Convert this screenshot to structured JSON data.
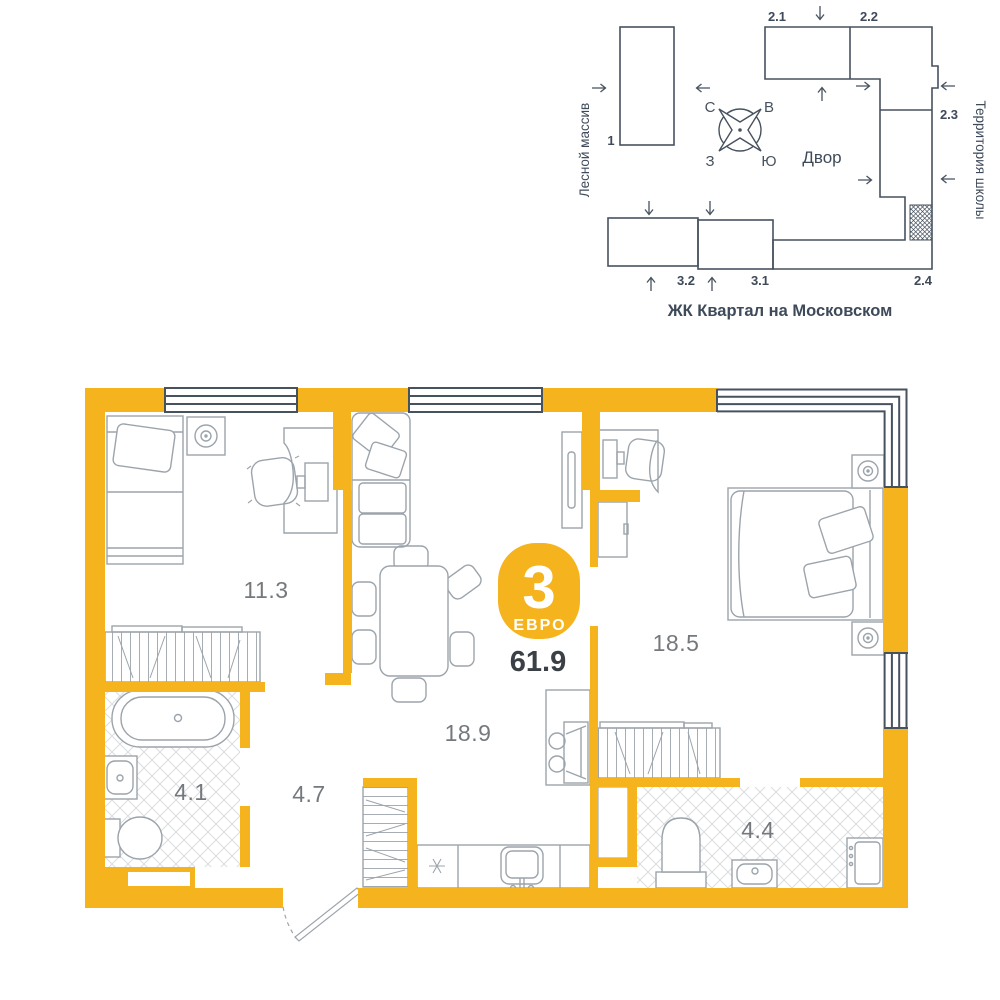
{
  "colors": {
    "wall_accent": "#F5B31D",
    "site_line": "#47525F",
    "site_text": "#3E4A59",
    "furniture_line": "#9CA4AB",
    "tile_line": "#DADDE0",
    "area_text": "#75797D",
    "total_text": "#3A4045",
    "badge_text": "#FFFFFF"
  },
  "site_plan": {
    "title": "ЖК Квартал на Московском",
    "left_label": "Лесной массив",
    "right_label": "Территория школы",
    "yard_label": "Двор",
    "compass": {
      "north": "С",
      "east": "В",
      "south": "Ю",
      "west": "З"
    },
    "buildings": {
      "b1": "1",
      "b21": "2.1",
      "b22": "2.2",
      "b23": "2.3",
      "b24": "2.4",
      "b31": "3.1",
      "b32": "3.2"
    }
  },
  "apartment": {
    "badge": {
      "rooms": "3",
      "type": "ЕВРО"
    },
    "total_area": "61.9",
    "rooms": [
      {
        "id": "bedroom-1",
        "area": "11.3"
      },
      {
        "id": "kitchen-living",
        "area": "18.9"
      },
      {
        "id": "bedroom-2",
        "area": "18.5"
      },
      {
        "id": "bathroom-1",
        "area": "4.1"
      },
      {
        "id": "hallway",
        "area": "4.7"
      },
      {
        "id": "bathroom-2",
        "area": "4.4"
      }
    ]
  }
}
